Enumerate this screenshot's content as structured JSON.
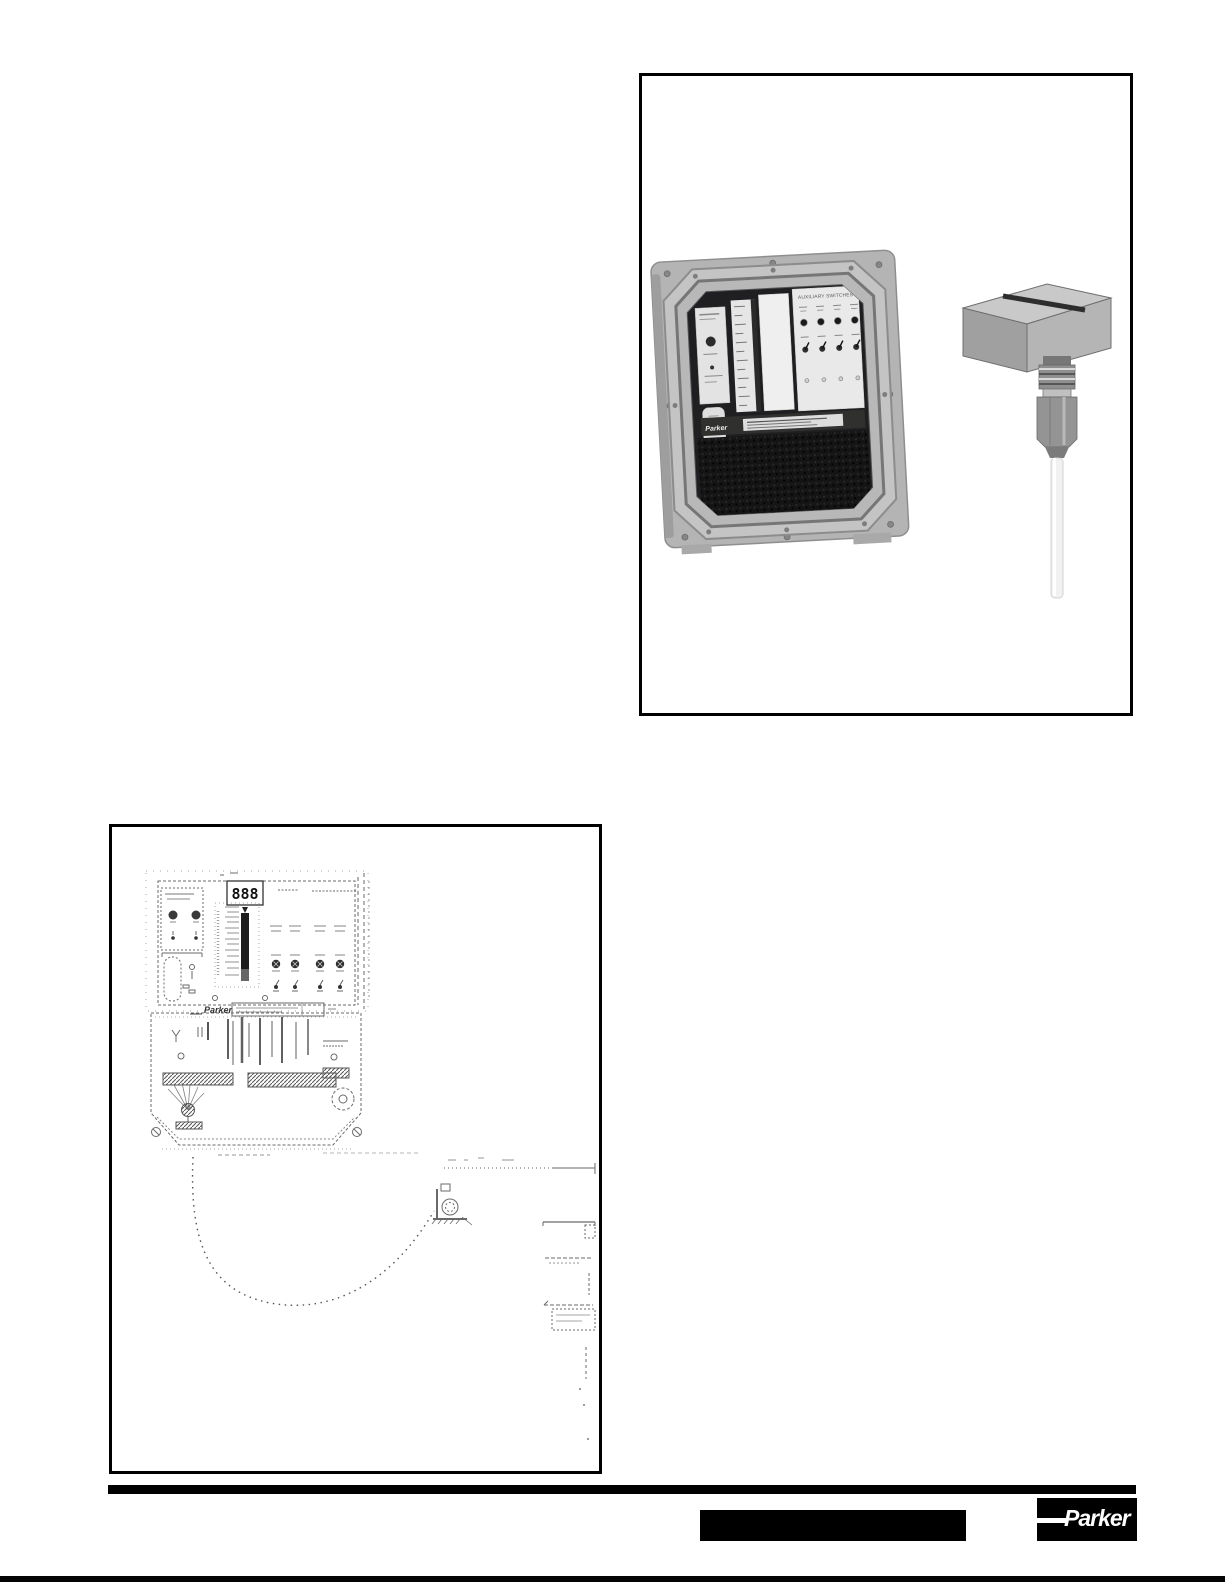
{
  "page": {
    "background_color": "#ffffff"
  },
  "photo_figure": {
    "control_box": {
      "panel_title": "AUXILIARY SWITCHES",
      "brand_label": "Parker",
      "led_count": 4,
      "switch_count": 4
    },
    "sensor": {
      "semantic": "level-sensor-probe-with-cable"
    }
  },
  "diagram_figure": {
    "display_value": "888",
    "brand_label": "Parker"
  },
  "footer": {
    "logo_text": "Parker",
    "divider_color": "#000000",
    "label_box_color": "#000000",
    "logo_bg": "#000000",
    "logo_fg": "#ffffff"
  }
}
